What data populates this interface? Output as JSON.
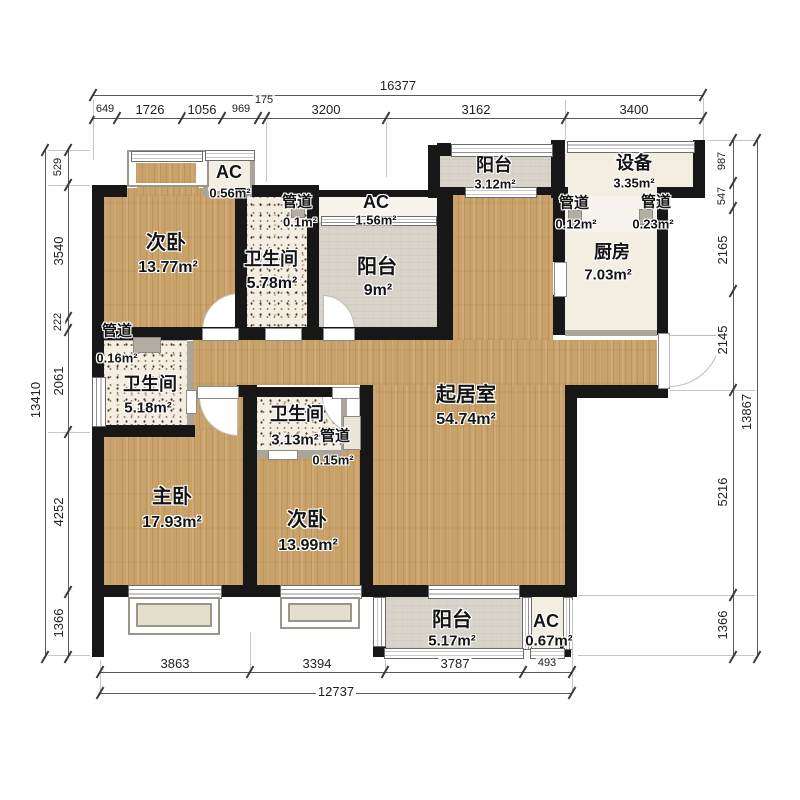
{
  "rooms": {
    "bedroom2_top": {
      "name": "次卧",
      "area": "13.77m²"
    },
    "ac_056": {
      "name": "AC",
      "area": "0.56m²"
    },
    "duct_01": {
      "name": "管道",
      "area": "0.1m²"
    },
    "bath_578": {
      "name": "卫生间",
      "area": "5.78m²"
    },
    "ac_156": {
      "name": "AC",
      "area": "1.56m²"
    },
    "balcony_9": {
      "name": "阳台",
      "area": "9m²"
    },
    "balcony_312": {
      "name": "阳台",
      "area": "3.12m²"
    },
    "equip_335": {
      "name": "设备",
      "area": "3.35m²"
    },
    "duct_012": {
      "name": "管道",
      "area": "0.12m²"
    },
    "duct_023": {
      "name": "管道",
      "area": "0.23m²"
    },
    "kitchen": {
      "name": "厨房",
      "area": "7.03m²"
    },
    "living": {
      "name": "起居室",
      "area": "54.74m²"
    },
    "duct_016": {
      "name": "管道",
      "area": "0.16m²"
    },
    "bath_518": {
      "name": "卫生间",
      "area": "5.18m²"
    },
    "bath_313": {
      "name": "卫生间",
      "area": "3.13m²"
    },
    "duct_015": {
      "name": "管道",
      "area": "0.15m²"
    },
    "master": {
      "name": "主卧",
      "area": "17.93m²"
    },
    "bedroom2_bot": {
      "name": "次卧",
      "area": "13.99m²"
    },
    "balcony_517": {
      "name": "阳台",
      "area": "5.17m²"
    },
    "ac_067": {
      "name": "AC",
      "area": "0.67m²"
    }
  },
  "dims": {
    "top": {
      "total": "16377",
      "segments": [
        "649",
        "1726",
        "1056",
        "969",
        "175",
        "3200",
        "3162",
        "3400"
      ]
    },
    "left": {
      "total": "13410",
      "segments": [
        "529",
        "3540",
        "222",
        "2061",
        "4252",
        "1366"
      ]
    },
    "right": {
      "total": "13867",
      "segments": [
        "987",
        "547",
        "2165",
        "2145",
        "5216",
        "1366"
      ]
    },
    "bottom": {
      "total": "12737",
      "segments": [
        "3863",
        "3394",
        "3787",
        "493"
      ]
    }
  },
  "colors": {
    "wall": "#171717",
    "wood_floor": "#c8a269",
    "tile": "#f4eee2",
    "balcony": "#d8d4c9"
  }
}
